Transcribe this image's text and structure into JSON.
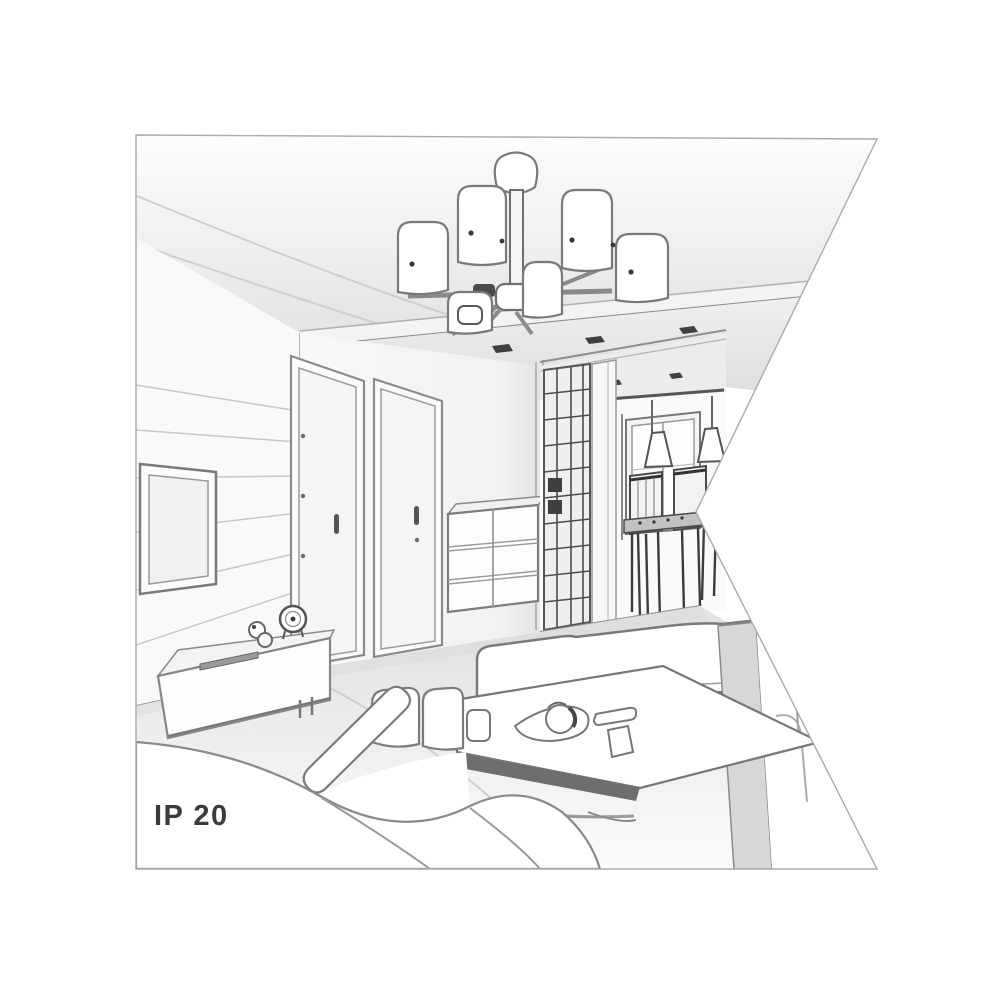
{
  "page": {
    "background": "#ffffff"
  },
  "illustration": {
    "kind": "interior-line-drawing",
    "ip_rating_label": "IP 20",
    "colors": {
      "background": "#ffffff",
      "outline": "#7a7a7a",
      "dark_accent": "#3f3f3f",
      "light_shade": "#ececec",
      "mid_shade": "#d7d7d7",
      "frame_border": "#ababab",
      "label_text": "#3b3b3b"
    },
    "objects": [
      "six-shade-ceiling-chandelier",
      "dropped-ceiling-with-spotlights",
      "tv-wall-panels",
      "wall-mounted-tv",
      "tv-bench-with-clock",
      "interior-door-left",
      "interior-door-right",
      "drawer-chest",
      "hallway-glass-wardrobe",
      "hallway-window",
      "dining-table-with-chairs",
      "cone-pendant-lamps",
      "corner-sofa",
      "right-sofa",
      "coffee-table-with-tea-set"
    ]
  }
}
